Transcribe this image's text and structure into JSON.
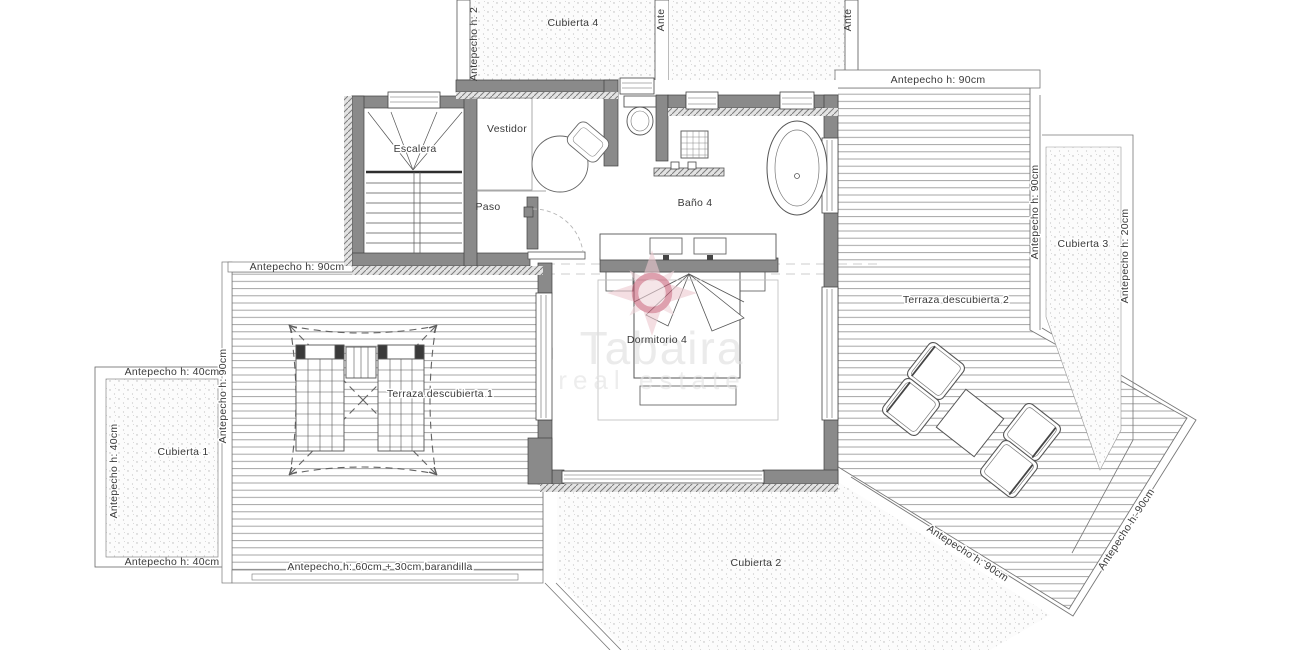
{
  "plan": {
    "rooms": {
      "escalera": "Escalera",
      "vestidor": "Vestidor",
      "paso": "Paso",
      "bano": "Baño 4",
      "dormitorio": "Dormitorio 4",
      "terraza1": "Terraza descubierta 1",
      "terraza2": "Terraza descubierta 2",
      "cubierta1": "Cubierta 1",
      "cubierta2": "Cubierta 2",
      "cubierta3": "Cubierta 3",
      "cubierta4": "Cubierta 4"
    },
    "annotations": {
      "h90": "Antepecho h: 90cm",
      "h40": "Antepecho h: 40cm",
      "h20": "Antepecho h: 20cm",
      "h60_barandilla": "Antepecho h: 60cm + 30cm barandilla",
      "h2_clipped": "Antepecho h: 2",
      "ante_clipped": "Ante"
    },
    "watermark": {
      "brand": "Tabaira",
      "tagline": "real estate"
    },
    "colors": {
      "wall": "#8a8a8a",
      "line": "#4f4f4f",
      "watermark_pink": "#c9627a",
      "watermark_ray": "#edc9d0",
      "watermark_text": "#dedede"
    }
  }
}
